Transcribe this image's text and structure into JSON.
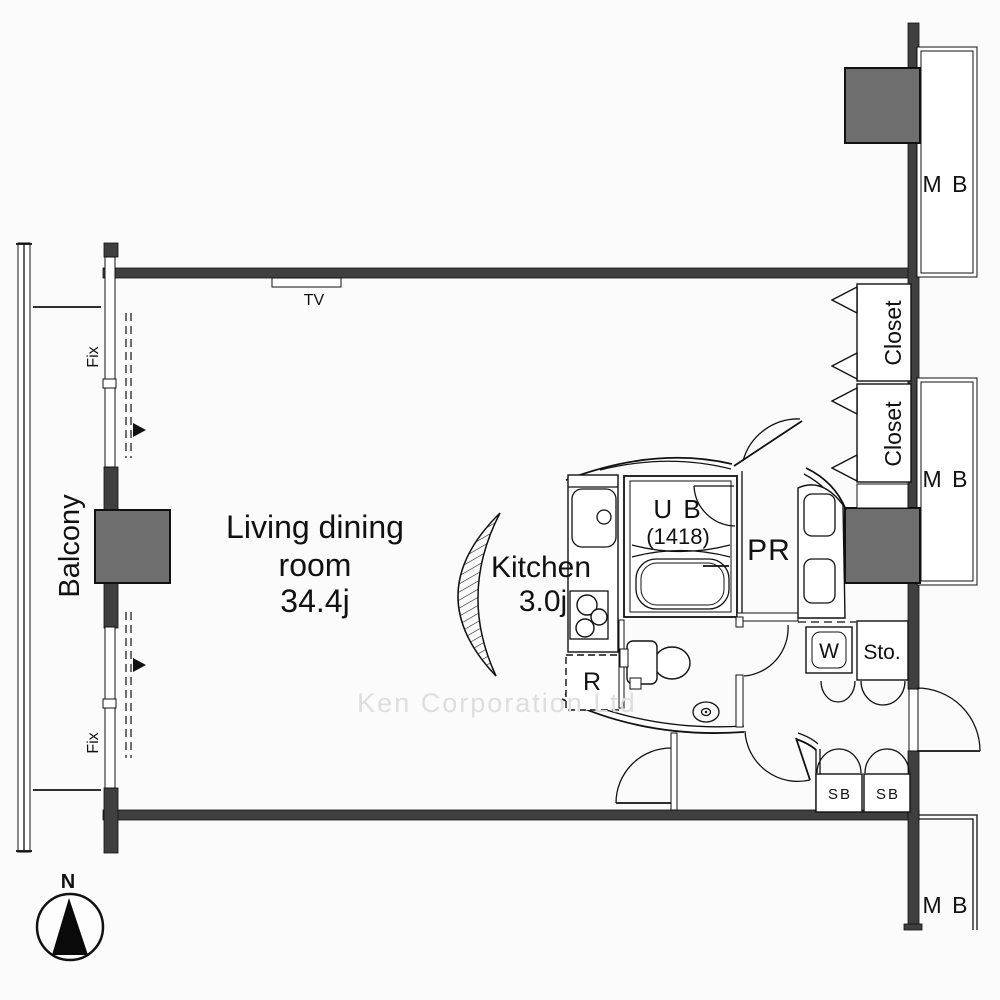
{
  "plan": {
    "watermark": "Ken Corporation Ltd",
    "compass_label": "N",
    "rooms": {
      "living": {
        "line1": "Living dining",
        "line2": "room",
        "area": "34.4j"
      },
      "kitchen": {
        "name": "Kitchen",
        "area": "3.0j"
      },
      "unit_bath": {
        "name": "U B",
        "size": "(1418)"
      },
      "powder_room": {
        "name": "PR"
      },
      "balcony": {
        "name": "Balcony"
      }
    },
    "labels": {
      "tv": "TV",
      "fix": "Fix",
      "closet": "Closet",
      "meter_box": "M B",
      "washer": "W",
      "storage": "Sto.",
      "shoe_box": "SB",
      "refrigerator": "R"
    },
    "colors": {
      "wall": "#3f3f3f",
      "shaft": "#6e6e6e",
      "line": "#111111",
      "watermark": "#dedede",
      "background": "#fbfbfb"
    }
  }
}
